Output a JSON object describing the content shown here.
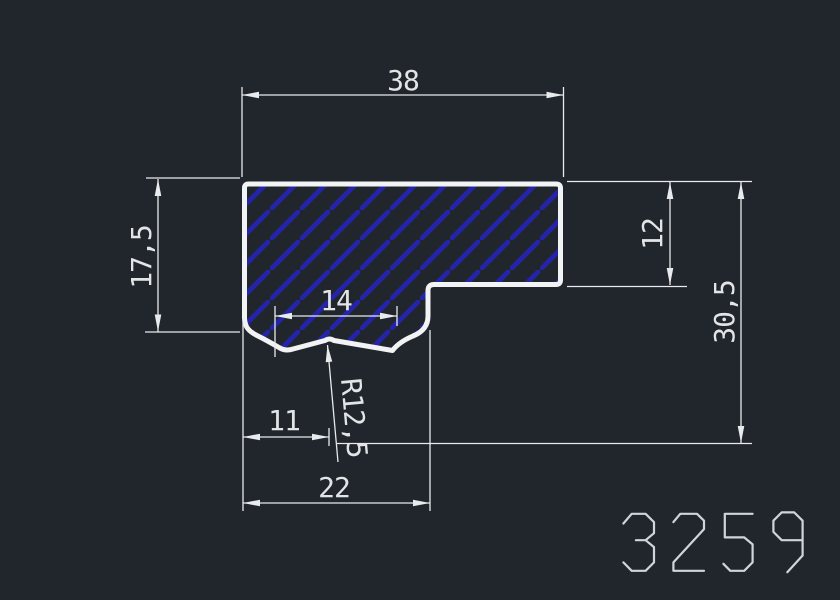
{
  "drawing": {
    "part_number": "3259",
    "colors": {
      "background": "#21262d",
      "outline": "#f2f3f4",
      "hatch": "#2424aa",
      "dim": "#e8eaec",
      "text": "#e2e4e6",
      "part_number": "#d2d5d8"
    },
    "dimensions": {
      "top_width": "38",
      "left_height": "17,5",
      "notch_width": "14",
      "notch_offset": "11",
      "bottom_width": "22",
      "notch_radius": "R12,5",
      "step_height": "12",
      "total_height": "30,5"
    }
  }
}
